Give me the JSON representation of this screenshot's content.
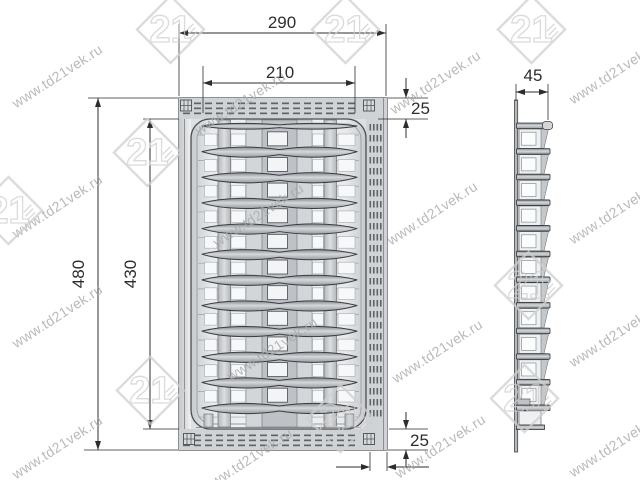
{
  "watermark": {
    "url_text": "www.td21vek.ru",
    "logo_text": "21"
  },
  "views": {
    "front": {
      "dim_overall_width": "290",
      "dim_inner_width": "210",
      "dim_overall_height": "480",
      "dim_inner_height": "430",
      "dim_top_margin": "25",
      "dim_bottom_margin": "25"
    },
    "side": {
      "dim_depth": "45"
    }
  },
  "structure": {
    "front_rail_rows": 12,
    "plate_slots": 11,
    "side_pockets": 11
  }
}
